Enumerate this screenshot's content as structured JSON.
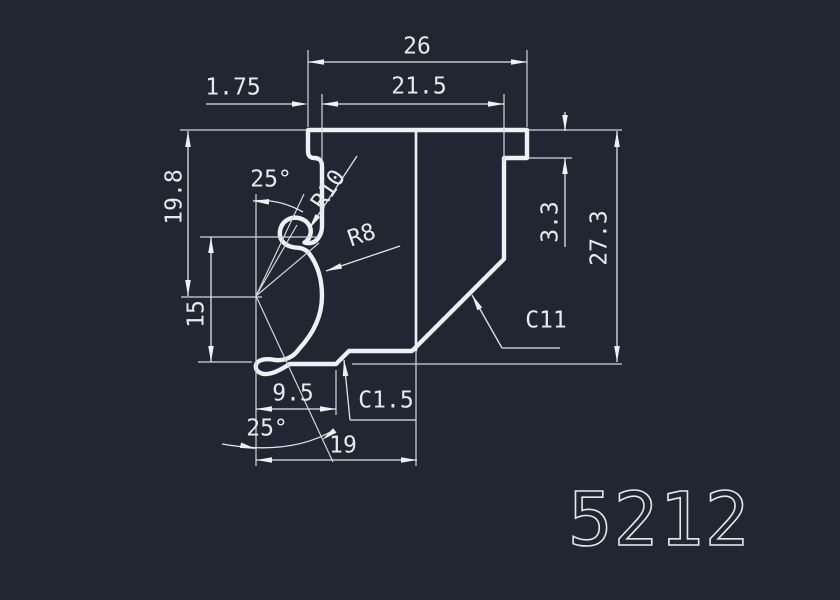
{
  "colors": {
    "background": "#202733",
    "line": "#eef1f4",
    "text": "#e6eaef"
  },
  "drawing": {
    "part_number": "5212",
    "dims": {
      "width_overall": "26",
      "width_inner": "21.5",
      "offset_left": "1.75",
      "height_left_upper": "19.8",
      "height_left_lower": "15",
      "angle_upper": "25°",
      "radius_neck": "R10",
      "radius_bulge": "R8",
      "step_right": "3.3",
      "height_overall": "27.3",
      "chamfer_right": "C11",
      "chamfer_bottom": "C1.5",
      "width_bottom_inner": "9.5",
      "angle_lower": "25°",
      "width_bottom": "19"
    }
  }
}
